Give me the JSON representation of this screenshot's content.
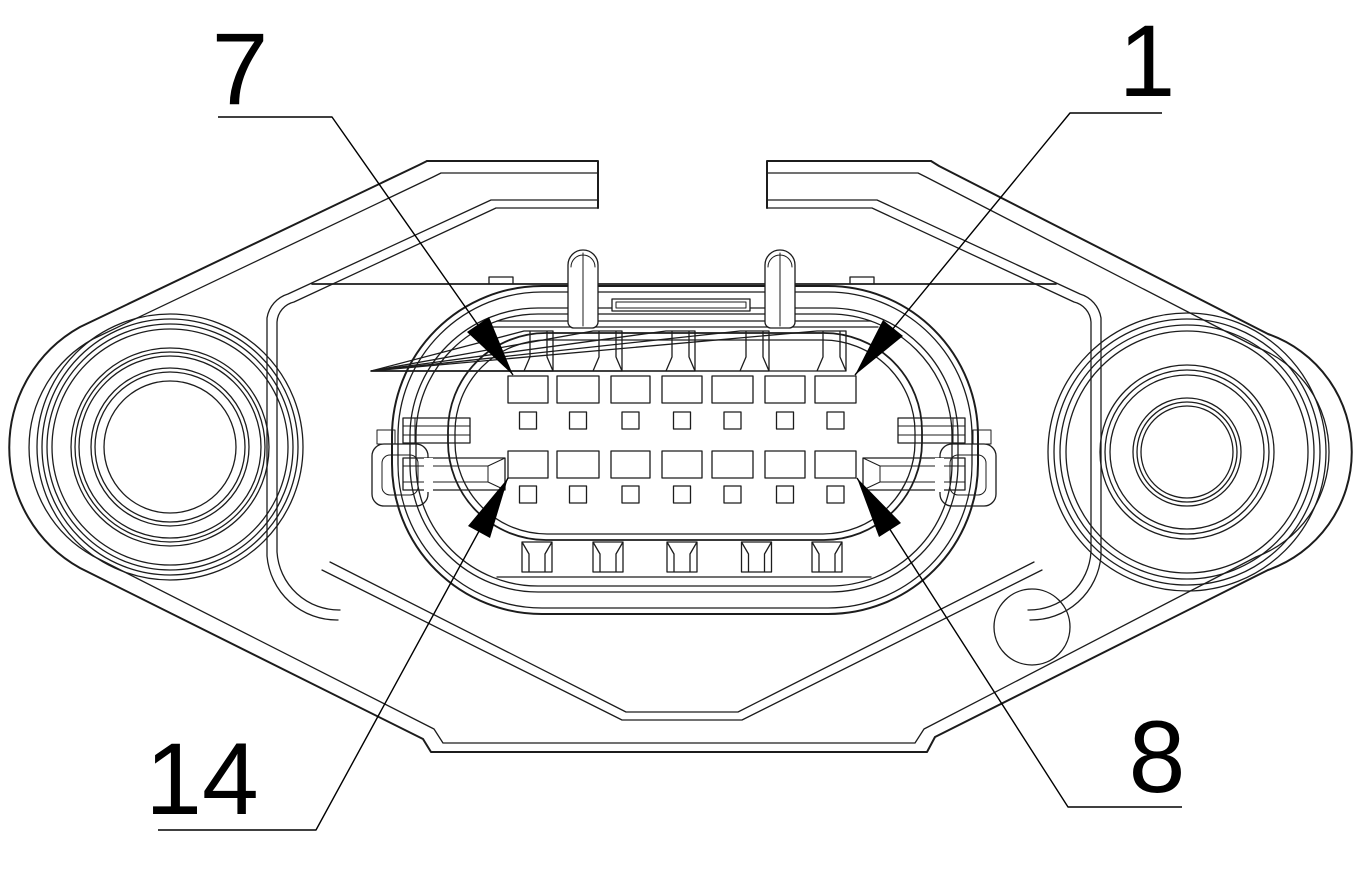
{
  "figure": {
    "background": "#ffffff",
    "line_color": "#1c1c1c",
    "callout_color": "#000000",
    "callouts": [
      {
        "id": "pin-7",
        "label": "7",
        "corner": "top-left"
      },
      {
        "id": "pin-1",
        "label": "1",
        "corner": "top-right"
      },
      {
        "id": "pin-14",
        "label": "14",
        "corner": "bottom-left"
      },
      {
        "id": "pin-8",
        "label": "8",
        "corner": "bottom-right"
      }
    ],
    "pin_grid": {
      "columns": 7,
      "large_rows": 2,
      "small_rows": 2,
      "total_pins": 14
    }
  }
}
